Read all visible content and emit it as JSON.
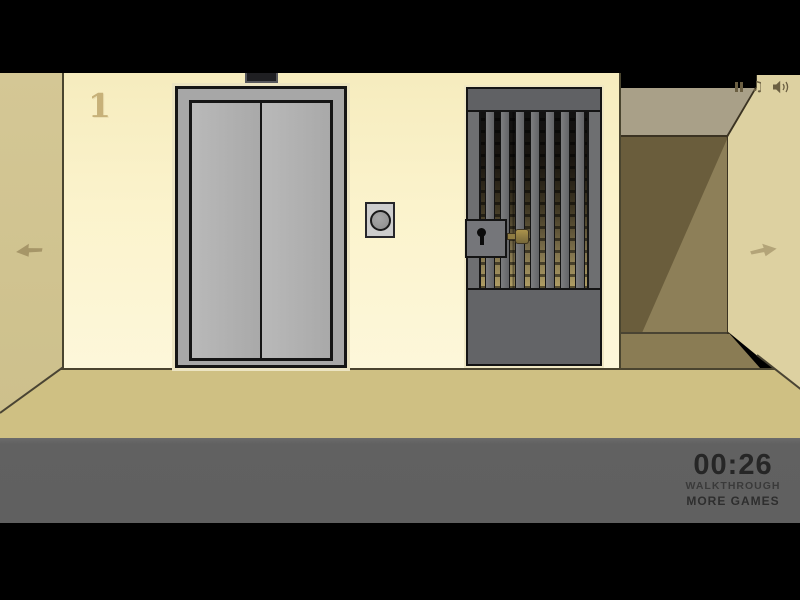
{
  "colors": {
    "letterbox": "#000000",
    "wall": "#FBF3CC",
    "wall_left": "#D4C795",
    "right_wall": "#DDD1A1",
    "floor": "#CFC083",
    "hud_bar": "#616161",
    "elevator_metal": "#A9A9A9",
    "gate_metal": "#6E6F71",
    "corridor_dark": "#6A5D3C",
    "corridor_light": "#8D7F58",
    "key_brass": "#9C8847",
    "icon": "#6B5F42",
    "hud_text": "#2B2B2B"
  },
  "hud": {
    "floor_indicator": "1",
    "timer": "00:26",
    "walkthrough_label": "WALKTHROUGH",
    "more_games_label": "MORE GAMES"
  }
}
